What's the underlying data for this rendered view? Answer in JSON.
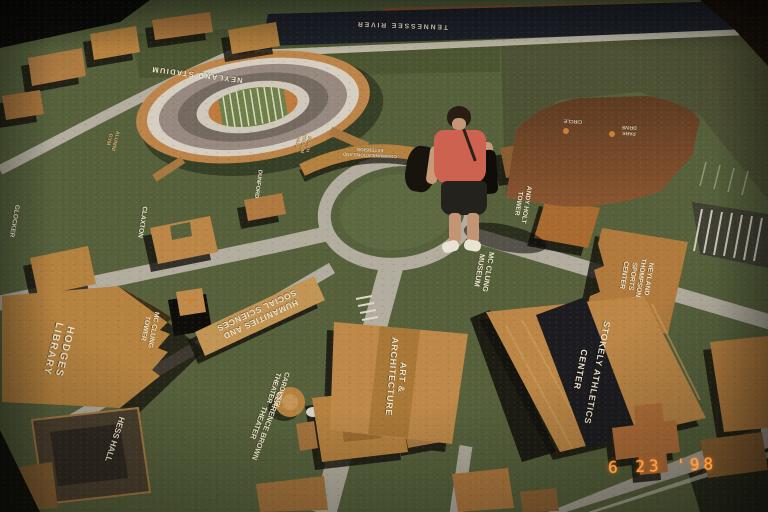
{
  "photo": {
    "date_stamp": "6 23 '98"
  },
  "map_labels": {
    "tennessee_river": "TENNESSEE RIVER",
    "neyland_stadium": "NEYLAND STADIUM",
    "alumni_gym": {
      "l1": "ALUMNI",
      "l2": "GYM"
    },
    "south_stadium": {
      "l1": "SOUTH",
      "l2": "STADIUM",
      "l3": "HALL"
    },
    "glocker": "GLOCKER",
    "claxton": "CLAXTON",
    "dunford": "DUNFORD",
    "hodges_library": {
      "l1": "HODGES",
      "l2": "LIBRARY"
    },
    "mcclung_tower": {
      "l1": "MC CLUNG",
      "l2": "TOWER"
    },
    "humanities": {
      "l1": "HUMANITIES AND",
      "l2": "SOCIAL SCIENCES"
    },
    "carousel_theater": {
      "l1": "CAROUSEL",
      "l2": "THEATER"
    },
    "clarence_brown": {
      "l1": "CLARENCE BROWN",
      "l2": "THEATER"
    },
    "hess_hall": "HESS HALL",
    "art_architecture": {
      "l1": "ART &",
      "l2": "ARCHITECTURE"
    },
    "communications": {
      "l1": "COMMUNICATIONS AND",
      "l2": "EXTENSION"
    },
    "mcclung_museum": {
      "l1": "MC CLUNG",
      "l2": "MUSEUM"
    },
    "andy_holt_tower": {
      "l1": "ANDY HOLT",
      "l2": "TOWER"
    },
    "circle": "CIRCLE",
    "park_drive": {
      "l1": "PARK",
      "l2": "DRIVE"
    },
    "neyland_thompson": {
      "l1": "NEYLAND",
      "l2": "THOMPSON",
      "l3": "SPORTS",
      "l4": "CENTER"
    },
    "stokely": {
      "l1": "STOKELY ATHLETICS",
      "l2": "CENTER"
    }
  },
  "colors": {
    "terrain_green": "#56613c",
    "building_tan": "#b5813f",
    "road_gray": "#b2ad9e",
    "river_navy": "#1c2129",
    "stokely_band": "#1c1c20",
    "label_cream": "#f0e6cc",
    "date_orange": "#ff9c3c"
  }
}
